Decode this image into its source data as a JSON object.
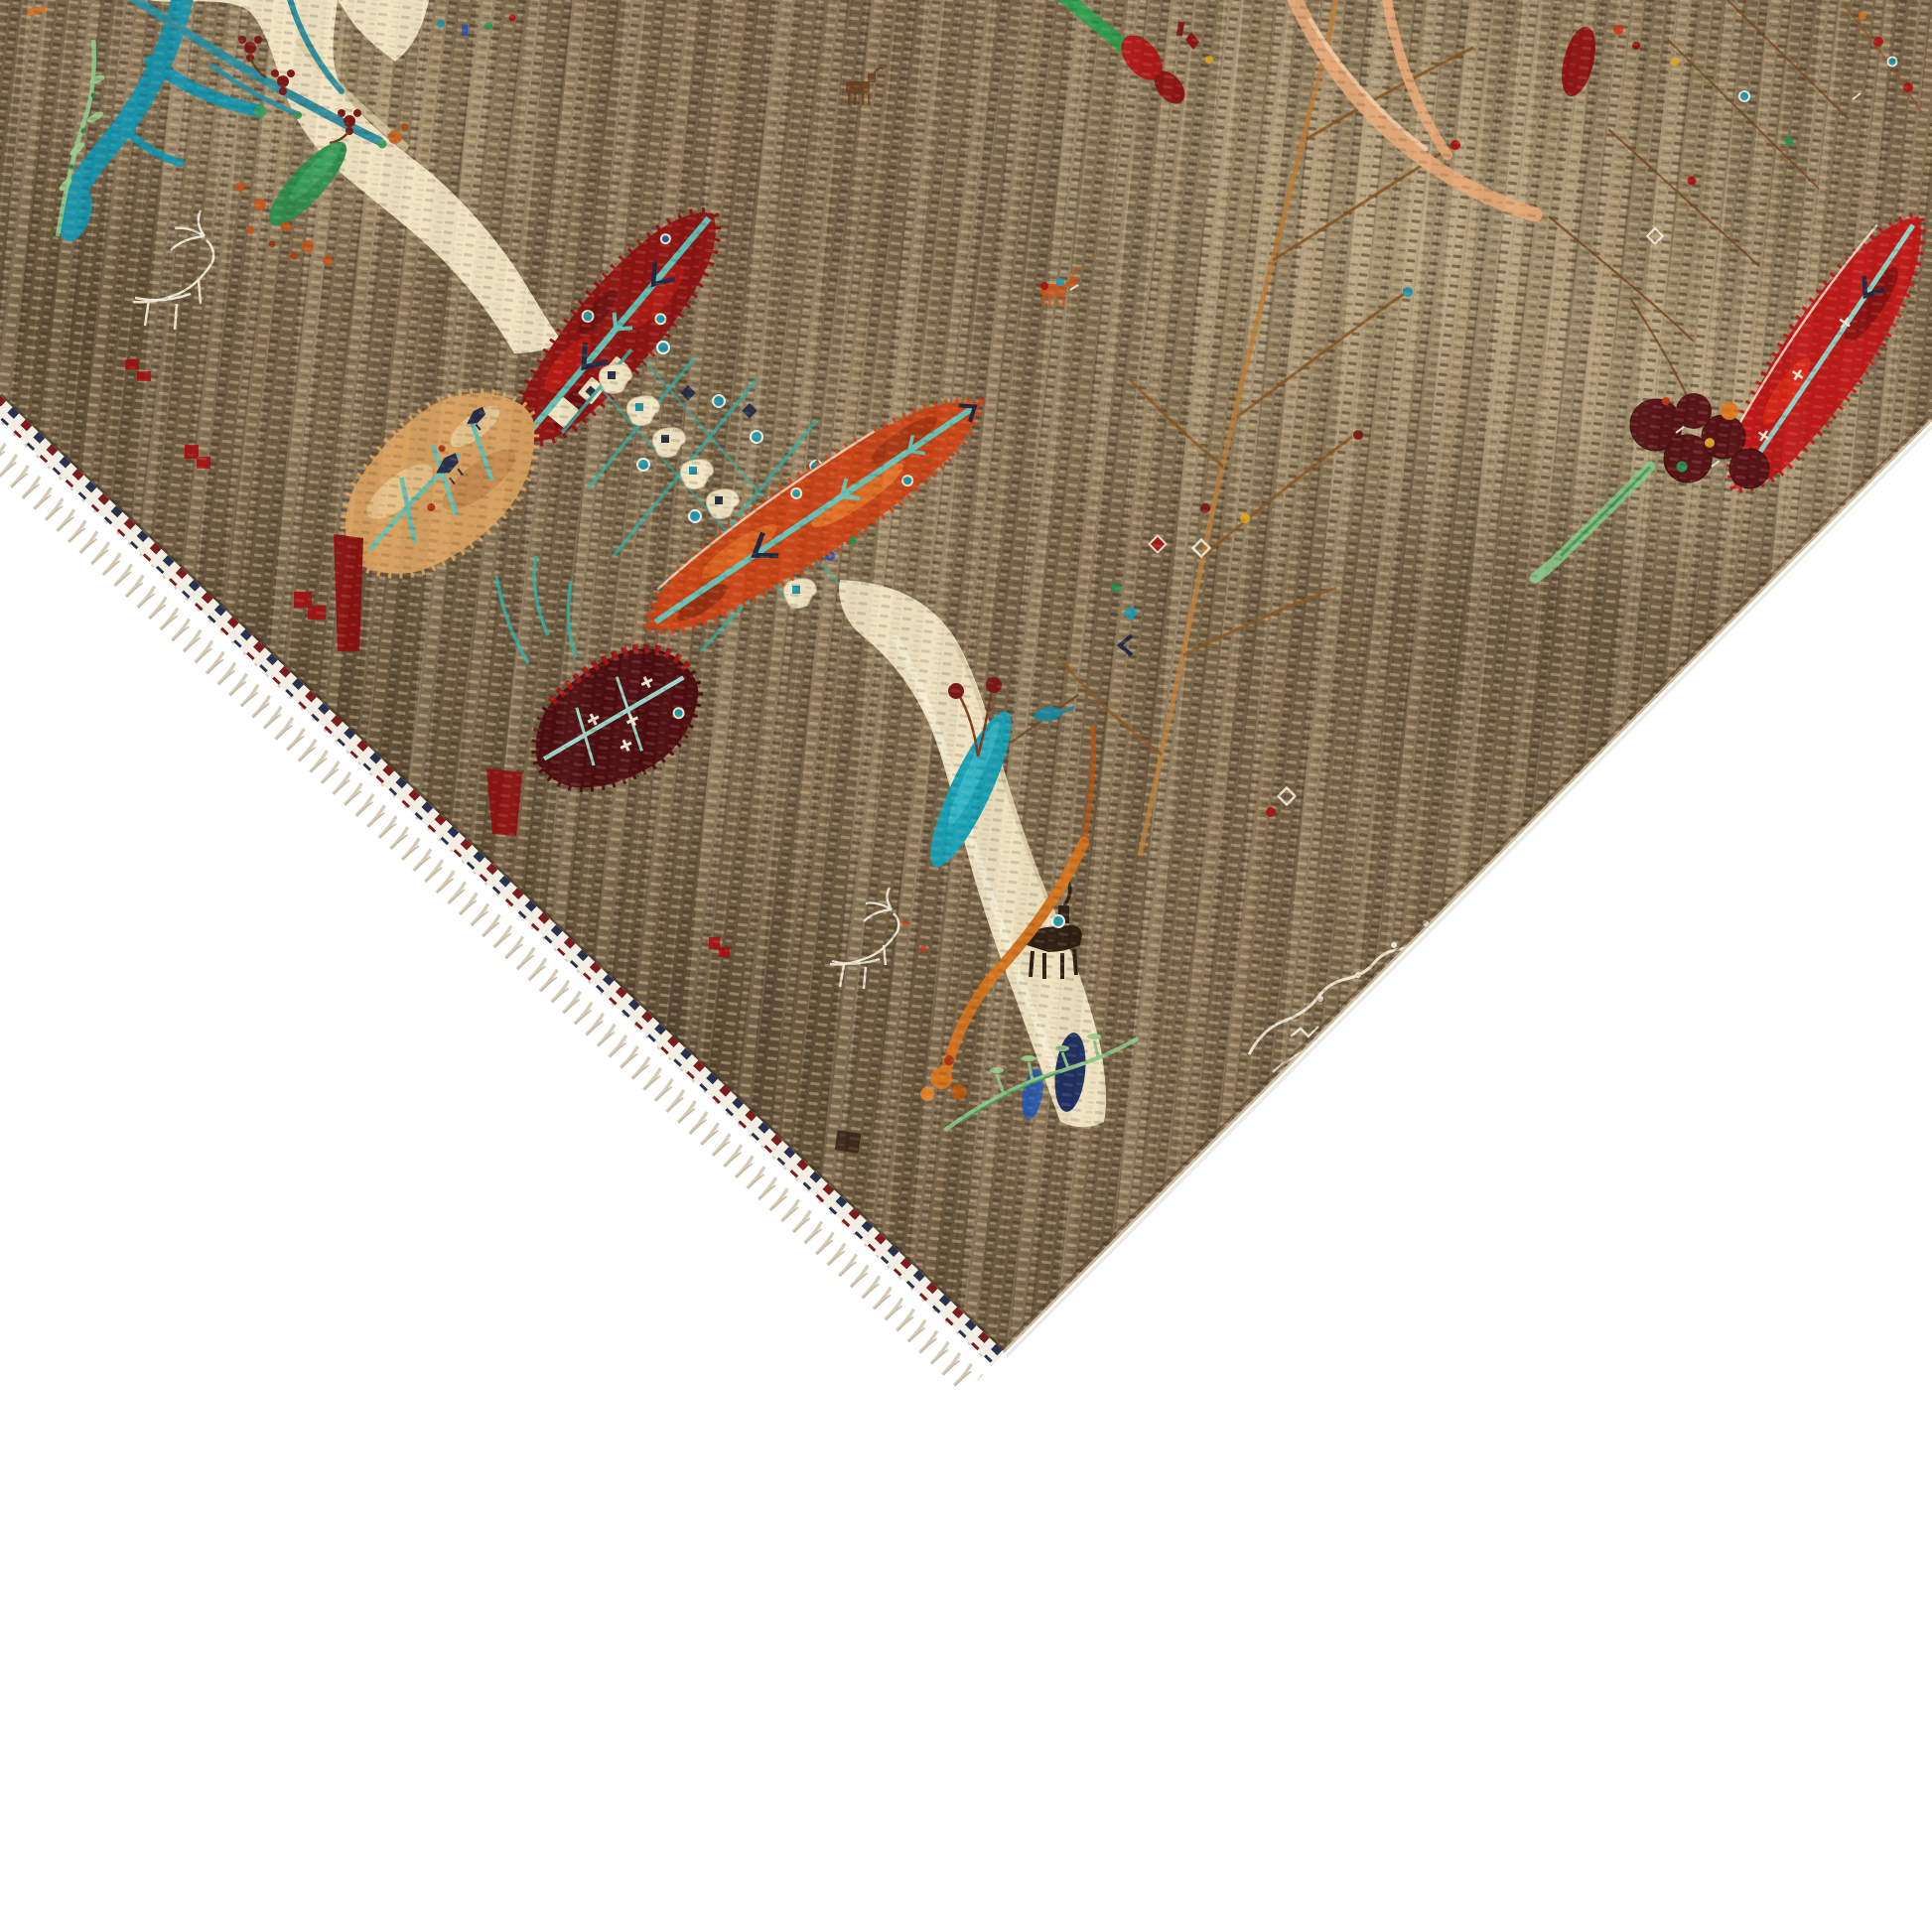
{
  "image": {
    "title": "Hand-knotted tribal rug corner on white background",
    "description": "Corner detail of a brown hand-knotted Gabbeh-style pictorial wool rug shown diagonally on a white background. The striated taupe field holds stylized cypress and willow trees in dark red, orange, maroon and tan, cream tree-trunk ribbons, turquoise branches, small animals, scattered flower buds and a woven white signature. Knotted cream fringe with a navy-and-red tipped selvage runs along the lower-left edge; the lower-right edge is clean bound.",
    "background_color": "#ffffff"
  },
  "rug": {
    "style": "pictorial tree-of-life gabbeh, wool, abrash striated field",
    "field_color": "#846f52",
    "fringe": {
      "tassel_color": "#d6cab6",
      "edge_stripe_colors": [
        "#28324f",
        "#7c1c1c",
        "#f2eee3"
      ]
    },
    "palette": {
      "field": "#846f52",
      "field_dark": "#473623",
      "field_light": "#cdb68c",
      "cream": "#f1e5c4",
      "teal": "#2196a8",
      "turquoise": "#17a3b8",
      "dark_red": "#8e1212",
      "maroon": "#4d0c11",
      "bright_red": "#c01818",
      "orange": "#cc4517",
      "tan": "#d7a05f",
      "peach": "#e5a878",
      "navy": "#232b46",
      "royal_blue": "#2757b0",
      "green": "#2e8f4e",
      "light_green": "#8fc48a",
      "gold": "#d9a520",
      "white_motif": "#f2ead8"
    },
    "motifs": [
      {
        "name": "turquoise-branch-tree",
        "color": "#1694ac"
      },
      {
        "name": "green-sprig",
        "color": "#8fc48a"
      },
      {
        "name": "cream-tree-trunk",
        "color": "#f1e5c4"
      },
      {
        "name": "dark-red-cypress",
        "color": "#8e1212"
      },
      {
        "name": "tan-willow-leaf",
        "color": "#d7a05f"
      },
      {
        "name": "castle-square-tree",
        "color": "#f2e6c6"
      },
      {
        "name": "maroon-willow-leaf",
        "color": "#4d0c11"
      },
      {
        "name": "orange-cypress",
        "color": "#cc4517"
      },
      {
        "name": "cream-river-trunk",
        "color": "#efe3c2"
      },
      {
        "name": "teal-leaf",
        "color": "#17a3b8"
      },
      {
        "name": "right-red-cypress",
        "color": "#c01818"
      },
      {
        "name": "peach-branch-tree",
        "color": "#e5a878"
      },
      {
        "name": "branch-sapling",
        "color": "#b87e3e"
      },
      {
        "name": "white-outline-deer",
        "color": "#f2ead8"
      },
      {
        "name": "goat-silhouette",
        "color": "#2c1d12"
      },
      {
        "name": "woven-signature",
        "color": "#f2ead8"
      },
      {
        "name": "navy-buds",
        "color": "#1d2f63"
      },
      {
        "name": "green-stem",
        "color": "#2f9e4f"
      }
    ]
  }
}
